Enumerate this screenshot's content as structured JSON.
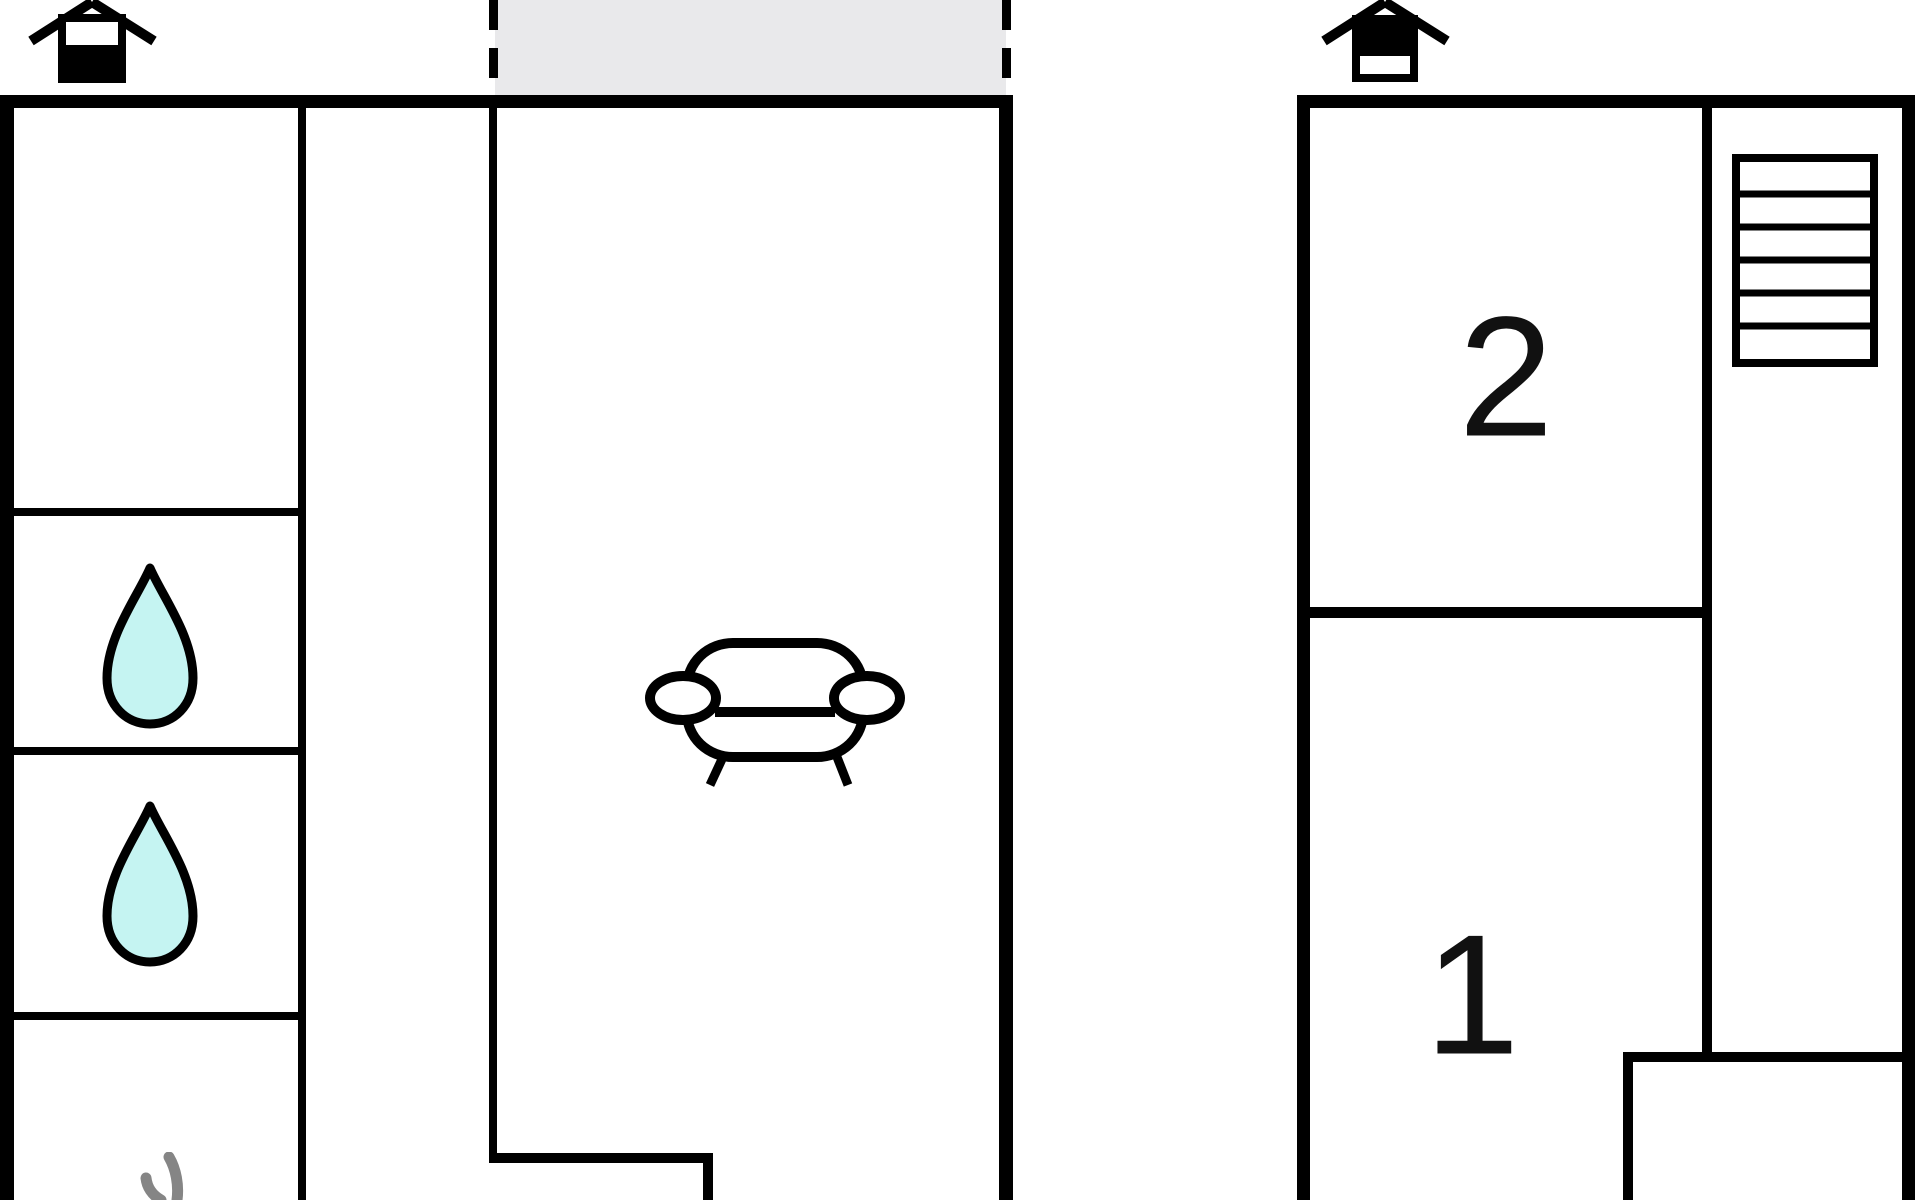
{
  "floor_plan": {
    "labels": {
      "bedroom_2": "2",
      "bedroom_1": "1"
    },
    "icons": {
      "ground_floor_entrance": "house-entrance-icon",
      "upper_floor_entrance": "house-entrance-icon",
      "bathroom_1": "water-drop-icon",
      "bathroom_2": "water-drop-icon",
      "shower_room": "steam-icon",
      "living_room": "sofa-icon",
      "stair_hall": "stairs-icon"
    },
    "colors": {
      "wall_color": "#000000",
      "porch_fill": "#e9e9eb",
      "water_drop_fill": "#c5f4f2",
      "steam_stroke": "#858585",
      "label_color": "#111111",
      "background": "#ffffff"
    }
  }
}
